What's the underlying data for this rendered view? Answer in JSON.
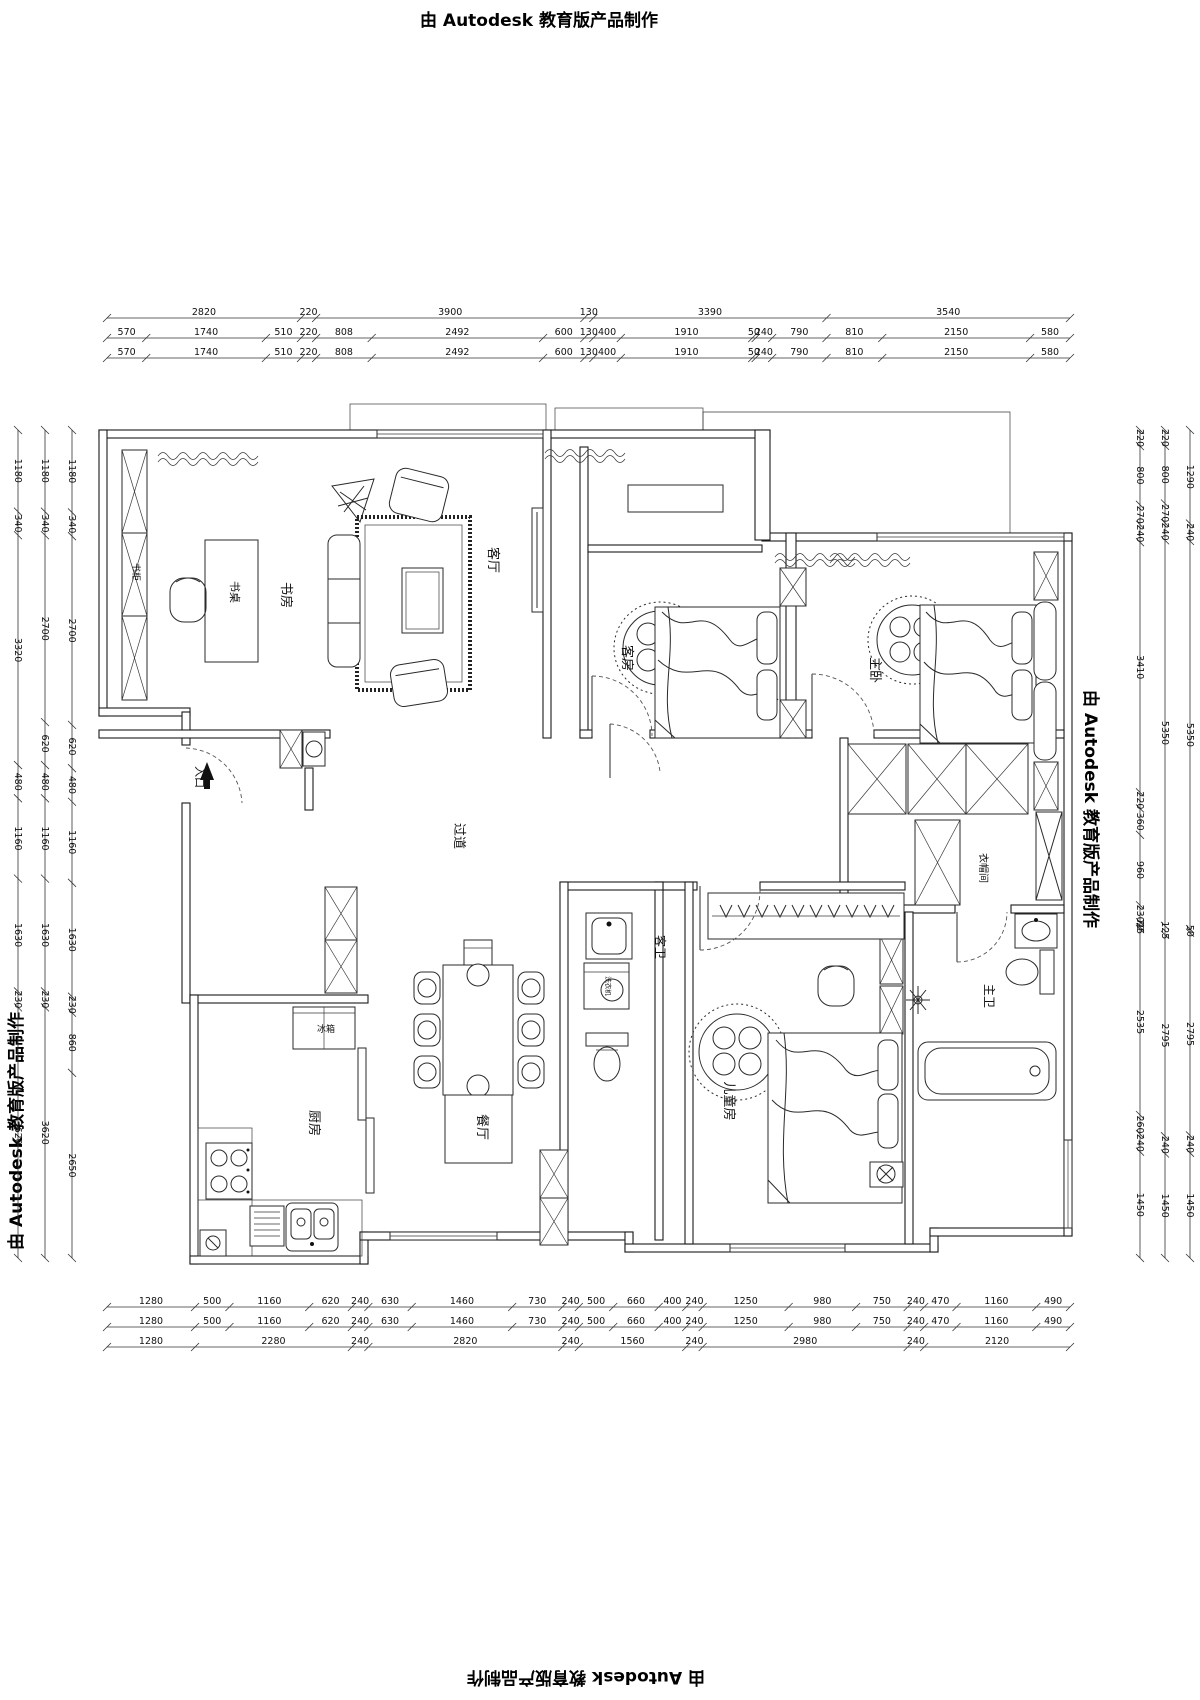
{
  "watermarks": {
    "top": "由 Autodesk 教育版产品制作",
    "bottom": "由 Autodesk 教育版产品制作",
    "left": "由 Autodesk 教育版产品制作",
    "right": "由 Autodesk 教育版产品制作"
  },
  "rooms": [
    {
      "id": "study",
      "label": "书房"
    },
    {
      "id": "desk",
      "label": "书桌"
    },
    {
      "id": "bookcase",
      "label": "书柜"
    },
    {
      "id": "living",
      "label": "客厅"
    },
    {
      "id": "guest",
      "label": "客房"
    },
    {
      "id": "master",
      "label": "主卧"
    },
    {
      "id": "corridor",
      "label": "过道"
    },
    {
      "id": "entry",
      "label": "入口"
    },
    {
      "id": "guest-bath",
      "label": "客卫"
    },
    {
      "id": "washer",
      "label": "洗衣机"
    },
    {
      "id": "cloak",
      "label": "衣帽间"
    },
    {
      "id": "master-bath",
      "label": "主卫"
    },
    {
      "id": "kids",
      "label": "儿童房"
    },
    {
      "id": "kitchen",
      "label": "厨房"
    },
    {
      "id": "fridge",
      "label": "冰箱"
    },
    {
      "id": "dining",
      "label": "餐厅"
    }
  ],
  "dimensions": {
    "top": [
      [
        "2820",
        "220",
        "3900",
        "130",
        "3390",
        "3540"
      ],
      [
        "570",
        "1740",
        "510",
        "220",
        "808",
        "2492",
        "600",
        "130",
        "400",
        "1910",
        "50",
        "240",
        "790",
        "810",
        "2150",
        "580"
      ],
      [
        "570",
        "1740",
        "510",
        "220",
        "808",
        "2492",
        "600",
        "130",
        "400",
        "1910",
        "50",
        "240",
        "790",
        "810",
        "2150",
        "580"
      ]
    ],
    "bottom": [
      [
        "1280",
        "500",
        "1160",
        "620",
        "240",
        "630",
        "1460",
        "730",
        "240",
        "500",
        "660",
        "400",
        "240",
        "1250",
        "980",
        "750",
        "240",
        "470",
        "1160",
        "490"
      ],
      [
        "1280",
        "500",
        "1160",
        "620",
        "240",
        "630",
        "1460",
        "730",
        "240",
        "500",
        "660",
        "400",
        "240",
        "1250",
        "980",
        "750",
        "240",
        "470",
        "1160",
        "490"
      ],
      [
        "1280",
        "2280",
        "240",
        "2820",
        "240",
        "1560",
        "240",
        "2980",
        "240",
        "2120"
      ]
    ],
    "left": [
      [
        "1180",
        "340",
        "2700",
        "620",
        "480",
        "1160",
        "1630",
        "230",
        "860",
        "2650"
      ],
      [
        "1180",
        "340",
        "2700",
        "620",
        "480",
        "1160",
        "1630",
        "230",
        "3620"
      ],
      [
        "1180",
        "340",
        "3320",
        "480",
        "1160",
        "1630",
        "230",
        "3620"
      ]
    ],
    "right": [
      [
        "220",
        "800",
        "270",
        "240",
        "3410",
        "220",
        "360",
        "960",
        "230",
        "70",
        "25",
        "2535",
        "260",
        "240",
        "1450"
      ],
      [
        "220",
        "800",
        "270",
        "240",
        "5350",
        "125",
        "2795",
        "240",
        "1450"
      ],
      [
        "1290",
        "240",
        "5350",
        "50",
        "2795",
        "240",
        "1450"
      ]
    ]
  }
}
